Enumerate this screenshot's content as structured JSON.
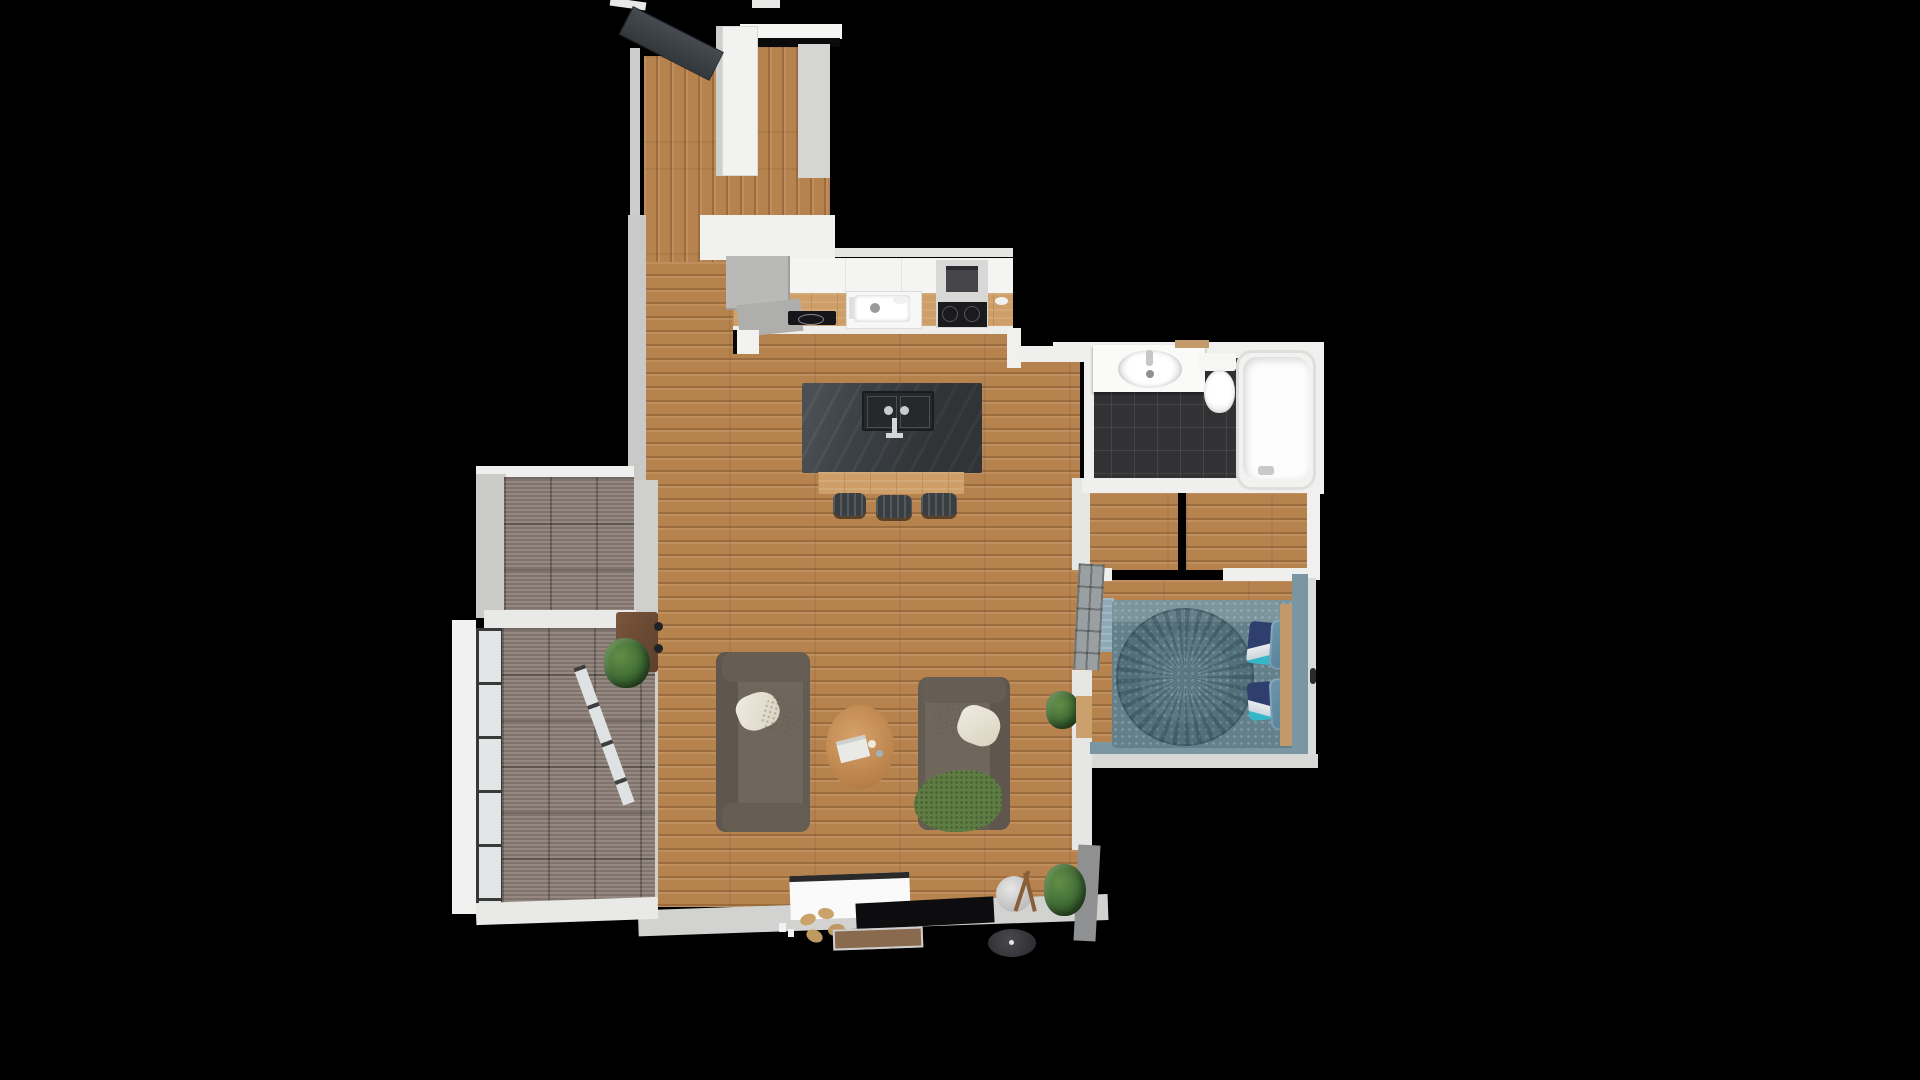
{
  "scene": {
    "description": "Top-down 3D rendered apartment floor plan on black background",
    "background": "#000000"
  },
  "palette": {
    "floor_wood": "#b6834e",
    "counter_wood": "#cf9f69",
    "wall_light": "#e9e9e7",
    "wall_gray": "#c9c9c7",
    "entry_door": "#3b4045",
    "island_slate": "#3d4246",
    "deck_gray": "#8d8179",
    "bath_tile": "#323235",
    "sofa_gray": "#6f675c",
    "bed_teal": "#64808a",
    "bed_band": "#7b96a3",
    "pillow_navy": "#2e3f6e",
    "pillow_teal": "#5b88a0",
    "throw_green": "#5f7d43",
    "plant_green": "#3f6b34",
    "table_wood": "#c89058",
    "planter_brown": "#6d4b34"
  },
  "names": {
    "entry_door": "entry door (open leaf)",
    "hall_wardrobe": "hallway wardrobe",
    "kitchen_upper": "kitchen back counter / cabinets",
    "kitchen_worktop": "kitchen wooden worktop",
    "kitchen_sink": "kitchen sink",
    "kitchen_hob": "built-in hob",
    "kitchen_stove": "stove with oven and cooktop",
    "corner_cabinet": "corner cabinet",
    "kitchen_window": "kitchen window wall",
    "island": "kitchen island with sink",
    "island_ledge": "island bar ledge",
    "bar_stool": "bar stool",
    "sofa_left": "sofa (left)",
    "sofa_right": "sofa (right) with green throw",
    "coffee_table": "round wooden coffee table",
    "magazine": "magazine",
    "dining_plant": "potted plant",
    "console": "console table",
    "terrace_upper": "upper terrace decking",
    "terrace_lower": "lower terrace decking",
    "terrace_rail": "glass balustrade",
    "terrace_divider": "terrace divider wall",
    "planter": "terrace planter box",
    "terrace_plant": "planter greenery",
    "terrace_door_rail": "terrace sliding door frame",
    "door_handles": "terrace door handles",
    "tv_lowboard": "TV lowboard",
    "tv_panel": "flat TV panel",
    "slippers": "slippers",
    "shoe_tray": "shoe tray",
    "robot_vacuum": "robot vacuum",
    "floor_lamp": "tripod floor lamp",
    "living_plant": "potted plant",
    "bath_vanity": "bathroom vanity with basin",
    "toilet": "toilet",
    "bathtub": "bathtub",
    "bath_floor": "bathroom tile floor",
    "bedroom_door": "bedroom door (open leaf)",
    "bed": "double bed with spiral quilt",
    "bed_pillow": "bed pillow",
    "headboard": "wooden headboard",
    "bed_bench": "footboard bench",
    "bedroom_rug": "bedroom rug",
    "hall_floor": "entry hall floor",
    "living_floor": "living room floor",
    "bedroom_floor": "bedroom floor",
    "corridor_floor": "corridor floor",
    "wall": "wall"
  }
}
